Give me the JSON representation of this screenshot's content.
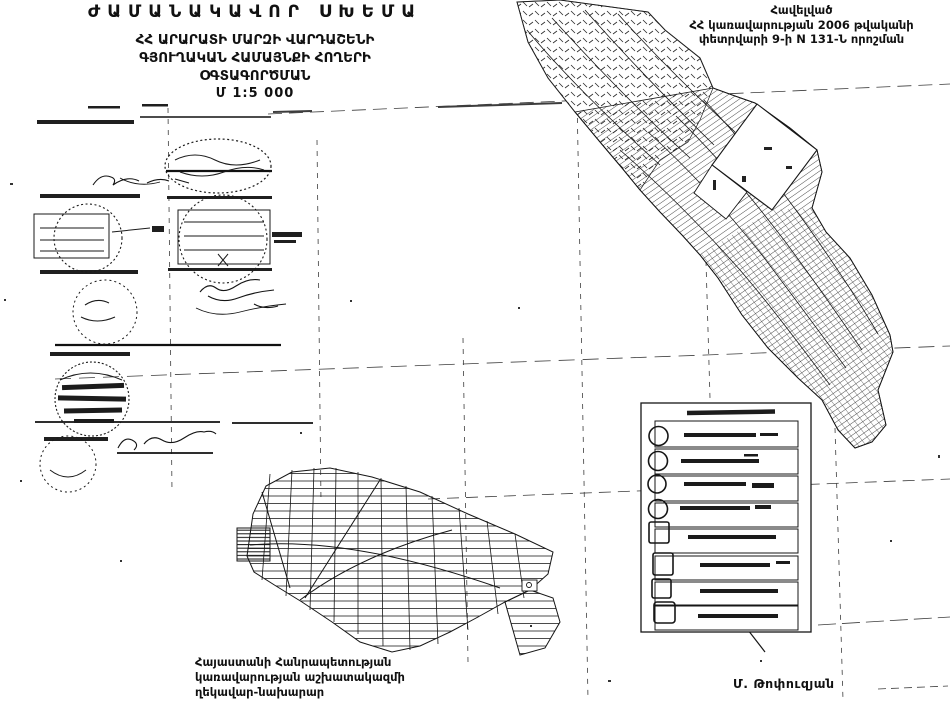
{
  "page": {
    "background": "#ffffff",
    "ink_color": "#111111",
    "kind": "scanned cadastral land-use scheme (black and white)"
  },
  "title_block": {
    "line1": "ԺԱՄԱՆԱԿԱՎՈՐ ՍԽԵՄԱ",
    "line2": "ՀՀ ԱՐԱՐԱՏԻ ՄԱՐԶԻ ՎԱՐԴԱՇԵՆԻ",
    "line3": "ԳՅՈՒՂԱԿԱՆ ՀԱՄԱՅՆՔԻ ՀՈՂԵՐԻ",
    "line4": "ՕԳՏԱԳՈՐԾՄԱՆ",
    "scale": "Մ 1:5 000"
  },
  "annex_note": {
    "line1": "Հավելված",
    "line2": "ՀՀ կառավարության 2006 թվականի",
    "line3": "փետրվարի 9-ի N 131-Ն որոշման"
  },
  "approval_block": {
    "line1": "Հայաստանի Հանրապետության",
    "line2": "կառավարության աշխատակազմի",
    "line3": "ղեկավար-նախարար"
  },
  "signatory": {
    "name": "Մ. Թոփուզյան"
  }
}
